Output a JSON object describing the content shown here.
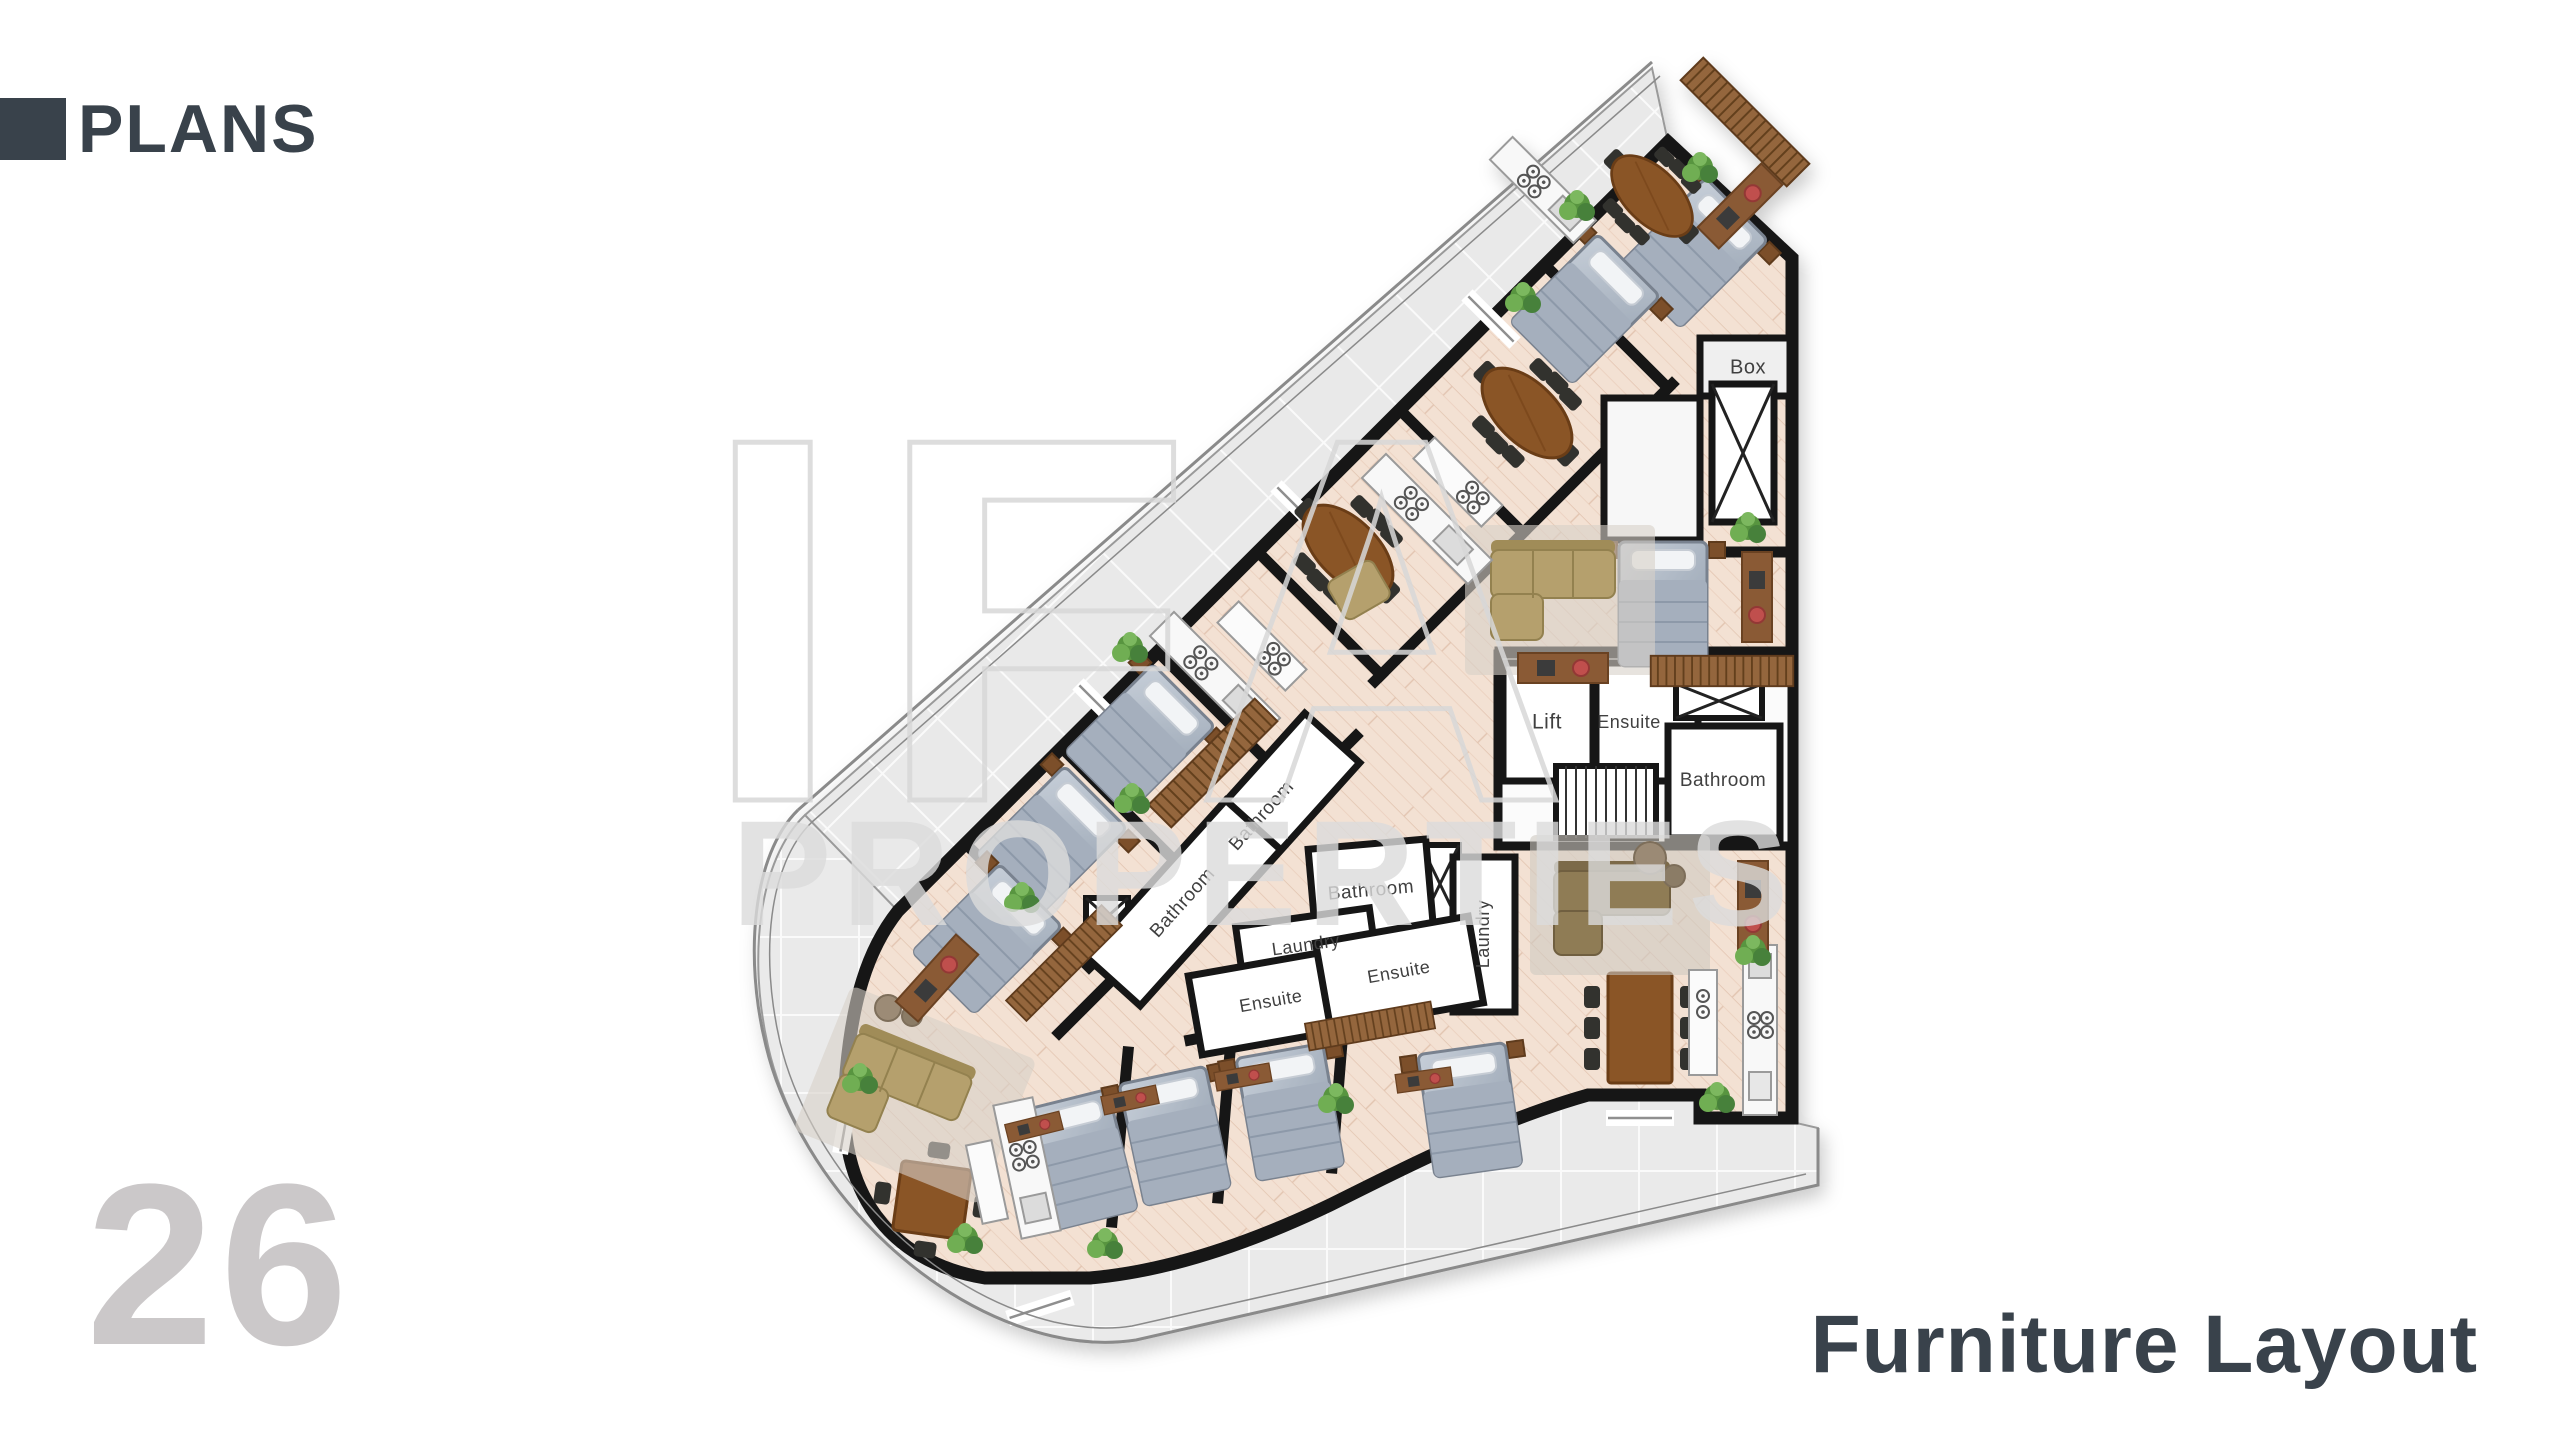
{
  "header": {
    "title": "PLANS"
  },
  "footer": {
    "page_number": "26",
    "caption": "Furniture Layout"
  },
  "watermark": {
    "line1": "IFA",
    "line2": "PROPERTIES"
  },
  "colors": {
    "accent": "#39424b",
    "page_number": "#cbc8c9"
  },
  "plan": {
    "room_labels": [
      {
        "text": "Box",
        "x": 1748,
        "y": 368,
        "rot": 0,
        "size": 20
      },
      {
        "text": "Lift",
        "x": 1547,
        "y": 723,
        "rot": 0,
        "size": 21
      },
      {
        "text": "Ensuite",
        "x": 1629,
        "y": 723,
        "rot": 0,
        "size": 18
      },
      {
        "text": "Bathroom",
        "x": 1723,
        "y": 781,
        "rot": 0,
        "size": 19
      },
      {
        "text": "Bathroom",
        "x": 1262,
        "y": 816,
        "rot": -48,
        "size": 19
      },
      {
        "text": "Bathroom",
        "x": 1183,
        "y": 903,
        "rot": -48,
        "size": 19
      },
      {
        "text": "Bathroom",
        "x": 1371,
        "y": 891,
        "rot": -5,
        "size": 19
      },
      {
        "text": "Laundry",
        "x": 1306,
        "y": 946,
        "rot": -8,
        "size": 18
      },
      {
        "text": "Laundry",
        "x": 1484,
        "y": 934,
        "rot": -90,
        "size": 18
      },
      {
        "text": "Ensuite",
        "x": 1271,
        "y": 1002,
        "rot": -10,
        "size": 18
      },
      {
        "text": "Ensuite",
        "x": 1399,
        "y": 973,
        "rot": -10,
        "size": 18
      }
    ]
  }
}
